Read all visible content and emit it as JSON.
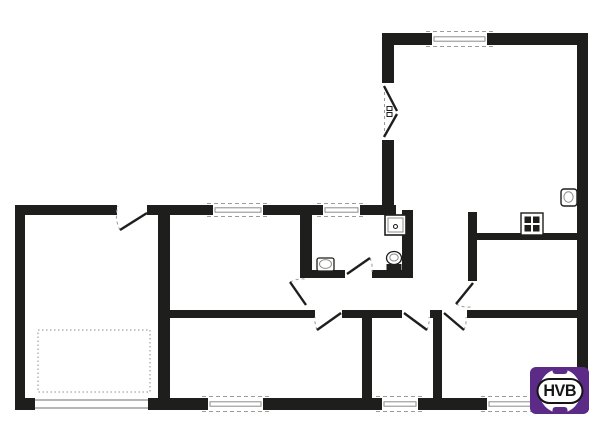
{
  "colors": {
    "wall": "#1e1e1c",
    "line": "#8c8c8c",
    "dash": "#9b9b9b",
    "bg": "#ffffff",
    "logo_purple": "#5b2b87",
    "logo_text": "#151515"
  },
  "logo": {
    "text": "HVB"
  },
  "plan": {
    "walls": [
      {
        "name": "wall-outer-top-1",
        "x": 15,
        "y": 205,
        "w": 102,
        "h": 10
      },
      {
        "name": "wall-outer-top-2",
        "x": 147,
        "y": 205,
        "w": 66,
        "h": 10
      },
      {
        "name": "wall-outer-top-3",
        "x": 263,
        "y": 205,
        "w": 60,
        "h": 10
      },
      {
        "name": "wall-outer-top-4",
        "x": 360,
        "y": 205,
        "w": 36,
        "h": 10
      },
      {
        "name": "wall-outer-left",
        "x": 15,
        "y": 205,
        "w": 10,
        "h": 205
      },
      {
        "name": "wall-outer-bottom-1",
        "x": 15,
        "y": 398,
        "w": 20,
        "h": 12
      },
      {
        "name": "wall-outer-bottom-2",
        "x": 148,
        "y": 398,
        "w": 60,
        "h": 12
      },
      {
        "name": "wall-outer-bottom-3",
        "x": 263,
        "y": 398,
        "w": 119,
        "h": 12
      },
      {
        "name": "wall-outer-bottom-4",
        "x": 418,
        "y": 398,
        "w": 69,
        "h": 12
      },
      {
        "name": "wall-outer-bottom-5",
        "x": 577,
        "y": 398,
        "w": 12,
        "h": 12
      },
      {
        "name": "wall-livingroom-top-left",
        "x": 382,
        "y": 33,
        "w": 50,
        "h": 12
      },
      {
        "name": "wall-livingroom-top-right",
        "x": 487,
        "y": 33,
        "w": 101,
        "h": 12
      },
      {
        "name": "wall-livingroom-left-upper",
        "x": 382,
        "y": 33,
        "w": 12,
        "h": 50
      },
      {
        "name": "wall-livingroom-left-lower",
        "x": 382,
        "y": 140,
        "w": 12,
        "h": 73
      },
      {
        "name": "wall-outer-right",
        "x": 577,
        "y": 33,
        "w": 11,
        "h": 379
      },
      {
        "name": "wall-garage-separator",
        "x": 158,
        "y": 215,
        "w": 12,
        "h": 183
      },
      {
        "name": "wall-hallway-bottom-1",
        "x": 170,
        "y": 310,
        "w": 145,
        "h": 8
      },
      {
        "name": "wall-hallway-bottom-2",
        "x": 342,
        "y": 310,
        "w": 60,
        "h": 8
      },
      {
        "name": "wall-hallway-bottom-3",
        "x": 430,
        "y": 310,
        "w": 12,
        "h": 8
      },
      {
        "name": "wall-hallway-bottom-4",
        "x": 467,
        "y": 310,
        "w": 110,
        "h": 8
      },
      {
        "name": "wall-bathroom-left",
        "x": 300,
        "y": 215,
        "w": 12,
        "h": 63
      },
      {
        "name": "wall-bathroom-bottom-1",
        "x": 300,
        "y": 270,
        "w": 45,
        "h": 8
      },
      {
        "name": "wall-bathroom-bottom-2",
        "x": 372,
        "y": 270,
        "w": 41,
        "h": 8
      },
      {
        "name": "wall-bathroom-right",
        "x": 402,
        "y": 210,
        "w": 11,
        "h": 68
      },
      {
        "name": "wall-kitchen-divider",
        "x": 468,
        "y": 212,
        "w": 9,
        "h": 69
      },
      {
        "name": "wall-kitchen-top",
        "x": 477,
        "y": 233,
        "w": 100,
        "h": 7
      },
      {
        "name": "wall-bedroom-separator-1",
        "x": 362,
        "y": 318,
        "w": 10,
        "h": 80
      },
      {
        "name": "wall-bedroom-separator-2",
        "x": 433,
        "y": 318,
        "w": 9,
        "h": 80
      }
    ],
    "windows": [
      {
        "name": "window-room-left",
        "x": 213,
        "y": 205,
        "w": 50,
        "h": 10,
        "style": "dashed"
      },
      {
        "name": "window-bathroom",
        "x": 323,
        "y": 205,
        "w": 37,
        "h": 10,
        "style": "dashed"
      },
      {
        "name": "window-livingroom-top",
        "x": 432,
        "y": 33,
        "w": 55,
        "h": 12,
        "style": "dashed"
      },
      {
        "name": "window-bedroom-1",
        "x": 208,
        "y": 398,
        "w": 55,
        "h": 12,
        "style": "dashed"
      },
      {
        "name": "window-bedroom-2",
        "x": 382,
        "y": 398,
        "w": 36,
        "h": 12,
        "style": "dashed"
      },
      {
        "name": "window-terrace",
        "x": 487,
        "y": 398,
        "w": 90,
        "h": 12,
        "style": "dashed"
      },
      {
        "name": "garage-door",
        "x": 35,
        "y": 398,
        "w": 113,
        "h": 12,
        "style": "plain"
      }
    ],
    "doors": [
      {
        "name": "garage-entry-door",
        "leaf": [
          147,
          213,
          120,
          230
        ],
        "arc": "M120,230 A30,30 0 0 1 118,206"
      },
      {
        "name": "livingroom-double-door",
        "dash": [
          384.5,
          86,
          384.5,
          137
        ],
        "leaf": [
          384,
          86,
          397,
          111
        ],
        "leaf2": [
          384,
          137,
          397,
          114
        ],
        "handles": [
          [
            387,
            106.5
          ],
          [
            387,
            112.5
          ]
        ]
      },
      {
        "name": "room-left-door",
        "leaf": [
          306,
          305,
          290,
          282
        ],
        "arc": "M290,282 A28,28 0 0 1 305,279"
      },
      {
        "name": "bathroom-door",
        "leaf": [
          347,
          274,
          370,
          258
        ],
        "arc": "M370,258 A27,27 0 0 1 372,272"
      },
      {
        "name": "kitchen-door",
        "leaf": [
          473,
          283,
          456,
          304
        ],
        "arc": "M456,304 A26,26 0 0 0 471,307"
      },
      {
        "name": "bedroom-1-door",
        "leaf": [
          341,
          313,
          317,
          330
        ],
        "arc": "M317,330 A28,28 0 0 1 315,317"
      },
      {
        "name": "bedroom-2-door",
        "leaf": [
          404,
          313,
          427,
          330
        ],
        "arc": "M427,330 A27,27 0 0 0 429,317"
      },
      {
        "name": "bottom-right-room-door",
        "leaf": [
          444,
          313,
          464,
          330
        ],
        "arc": "M464,330 A26,26 0 0 0 466,317"
      }
    ],
    "fixtures": [
      {
        "name": "shower-tray",
        "t": "rect",
        "x": 385,
        "y": 215,
        "w": 21,
        "h": 20,
        "s": "wall",
        "sw": 1.6,
        "f": "bg"
      },
      {
        "name": "shower-tray-inner",
        "t": "rect",
        "x": 388,
        "y": 218,
        "w": 15,
        "h": 14,
        "s": "line",
        "sw": 1
      },
      {
        "name": "shower-drain",
        "t": "circle",
        "cx": 395.5,
        "cy": 226.5,
        "r": 2,
        "s": "wall",
        "sw": 1.1
      },
      {
        "name": "toilet-bowl",
        "t": "ellipse",
        "cx": 394,
        "cy": 258,
        "rx": 7.5,
        "ry": 6.5,
        "s": "wall",
        "sw": 1.3,
        "f": "bg"
      },
      {
        "name": "toilet-bowl-inner",
        "t": "ellipse",
        "cx": 394,
        "cy": 257.5,
        "rx": 4.2,
        "ry": 3.5,
        "s": "line",
        "sw": 1
      },
      {
        "name": "toilet-tank",
        "t": "rect",
        "x": 386.5,
        "y": 264,
        "w": 15,
        "h": 6.5,
        "f": "wall"
      },
      {
        "name": "bathroom-sink",
        "t": "rect",
        "x": 317,
        "y": 258,
        "w": 17,
        "h": 13,
        "rx": 2,
        "s": "wall",
        "sw": 1.3,
        "f": "bg"
      },
      {
        "name": "bathroom-sink-basin",
        "t": "ellipse",
        "cx": 325.5,
        "cy": 264,
        "rx": 6,
        "ry": 4.4,
        "s": "line",
        "sw": 1
      },
      {
        "name": "kitchen-sink",
        "t": "rect",
        "x": 561,
        "y": 189,
        "w": 16,
        "h": 17,
        "rx": 3,
        "s": "wall",
        "sw": 1.4,
        "f": "bg"
      },
      {
        "name": "kitchen-sink-basin",
        "t": "ellipse",
        "cx": 568.5,
        "cy": 197,
        "rx": 4.6,
        "ry": 5.2,
        "s": "line",
        "sw": 1
      },
      {
        "name": "stove",
        "t": "rect",
        "x": 521,
        "y": 213,
        "w": 22,
        "h": 22,
        "s": "wall",
        "sw": 1.4,
        "f": "bg"
      },
      {
        "name": "stove-plate-1",
        "t": "rect",
        "x": 524.5,
        "y": 216.5,
        "w": 6.5,
        "h": 6.5,
        "f": "wall"
      },
      {
        "name": "stove-plate-2",
        "t": "rect",
        "x": 533,
        "y": 216.5,
        "w": 6.5,
        "h": 6.5,
        "f": "wall"
      },
      {
        "name": "stove-plate-3",
        "t": "rect",
        "x": 524.5,
        "y": 225,
        "w": 6.5,
        "h": 6.5,
        "f": "wall"
      },
      {
        "name": "stove-plate-4",
        "t": "rect",
        "x": 533,
        "y": 225,
        "w": 6.5,
        "h": 6.5,
        "f": "wall"
      },
      {
        "name": "garage-floor-marking",
        "t": "rect",
        "x": 38,
        "y": 330,
        "w": 112,
        "h": 62,
        "s": "line",
        "sw": 1,
        "da": "1.5 2.5"
      }
    ]
  }
}
